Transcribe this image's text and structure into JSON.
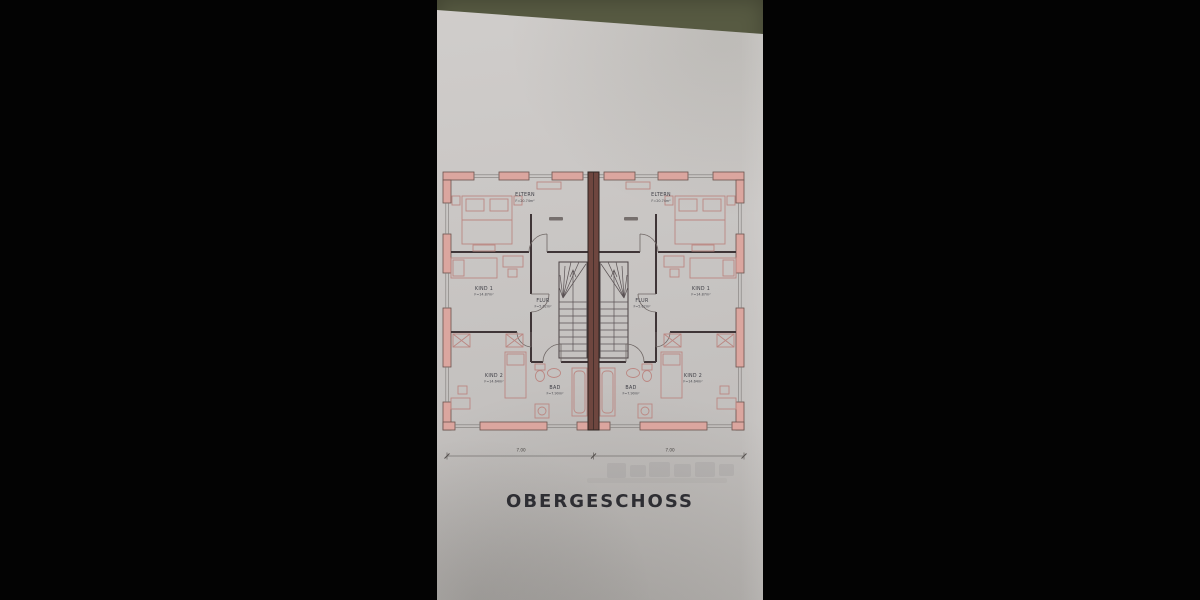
{
  "scene": {
    "kind": "photograph of an architectural floor plan on paper, letterboxed on black"
  },
  "plan": {
    "title": "OBERGESCHOSS",
    "dimension_line": {
      "left_label": "7.00",
      "right_label": "7.00"
    },
    "units": {
      "left": {
        "eltern": {
          "name": "ELTERN",
          "area": "F=20.74m²"
        },
        "kind1": {
          "name": "KIND 1",
          "area": "F=14.87m²"
        },
        "flur": {
          "name": "FLUR",
          "area": "F=5.62m²"
        },
        "kind2": {
          "name": "KIND 2",
          "area": "F=14.64m²"
        },
        "bad": {
          "name": "BAD",
          "area": "F=7.90m²"
        }
      },
      "right": {
        "eltern": {
          "name": "ELTERN",
          "area": "F=20.74m²"
        },
        "kind1": {
          "name": "KIND 1",
          "area": "F=14.87m²"
        },
        "flur": {
          "name": "FLUR",
          "area": "F=5.62m²"
        },
        "kind2": {
          "name": "KIND 2",
          "area": "F=14.64m²"
        },
        "bad": {
          "name": "BAD",
          "area": "F=7.90m²"
        }
      }
    },
    "colors": {
      "wall_fill": "#dba69f",
      "party_wall": "#6e463f",
      "paper": "#c8c5c3",
      "backdrop": "#575a42",
      "ink": "#3f3f46"
    }
  }
}
